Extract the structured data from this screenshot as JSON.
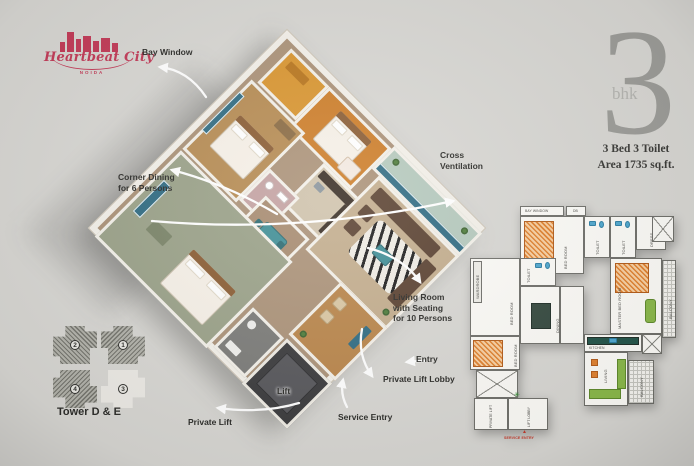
{
  "colors": {
    "background": "#d8d7d3",
    "logo": "#c23a57",
    "big_number": "#9c9c98",
    "info_text": "#3a3a37",
    "annotation_text": "#2b2b28",
    "arrow": "#ffffff",
    "lift_box": "#3a3a3c"
  },
  "logo": {
    "name": "Heartbeat City",
    "city": "NOIDA"
  },
  "unit_info": {
    "number": "3",
    "type": "bhk",
    "spec": "3 Bed 3 Toilet",
    "area": "Area 1735 sq.ft."
  },
  "annotations": {
    "bay_window": {
      "label": "Bay Window"
    },
    "corner_dining": {
      "line1": "Corner Dining",
      "line2": "for 6 Persons"
    },
    "cross_ventilation": {
      "line1": "Cross",
      "line2": "Ventilation"
    },
    "living_room": {
      "line1": "Living Room",
      "line2": "with Seating",
      "line3": "for 10 Persons"
    },
    "entry": {
      "label": "Entry"
    },
    "private_lift_lobby": {
      "label": "Private Lift Lobby"
    },
    "lift": {
      "label": "Lift"
    },
    "service_entry": {
      "label": "Service Entry"
    },
    "private_lift": {
      "label": "Private Lift"
    }
  },
  "tower": {
    "title": "Tower D & E",
    "units": [
      {
        "number": "2",
        "filled": true
      },
      {
        "number": "1",
        "filled": true
      },
      {
        "number": "4",
        "filled": true
      },
      {
        "number": "3",
        "filled": false
      }
    ]
  },
  "mini_plan": {
    "labels": {
      "bay_window": "BAY WINDOW",
      "db": "DB",
      "bed_room": "BED ROOM",
      "toilet": "TOILET",
      "dress": "DRESS",
      "master_bed_room": "MASTER BED ROOM",
      "balcony": "BALCONY",
      "wardrobe": "WARDROBE",
      "dining": "DINING",
      "kitchen": "KITCHEN",
      "living": "LIVING",
      "private_lift": "PRIVATE LIFT",
      "lift_lobby": "LIFT LOBBY",
      "service_entry": "SERVICE ENTRY"
    }
  }
}
